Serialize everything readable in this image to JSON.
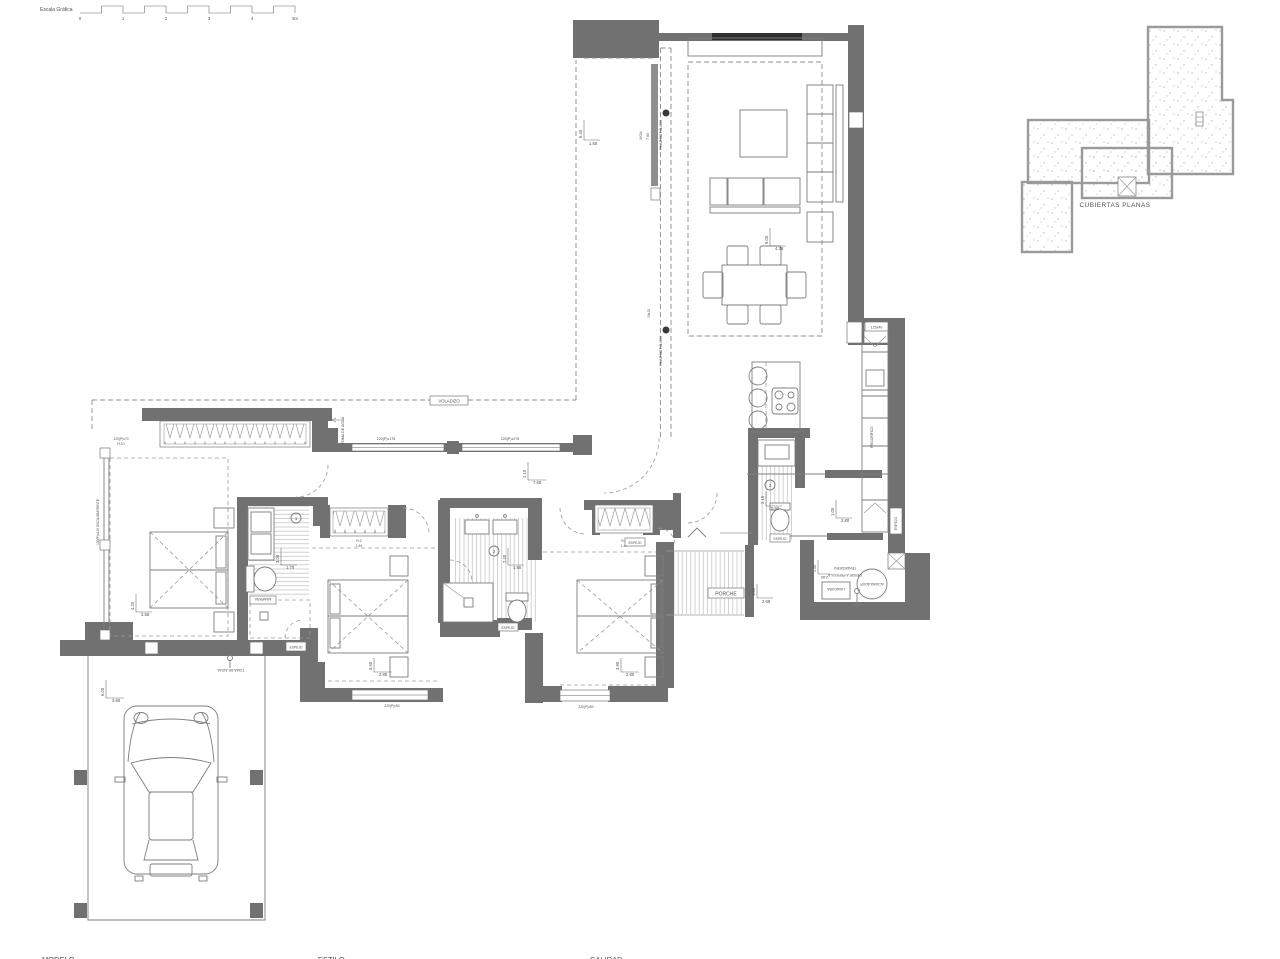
{
  "colors": {
    "wall": "#717171",
    "lintel": "#2f2f2f",
    "line": "#7d7d7d",
    "dash": "#8c8c8c",
    "text": "#4f4f4f"
  },
  "scalebar": {
    "title": "Escala Gráfica",
    "ticks": [
      "0",
      "1",
      "2",
      "3",
      "4",
      "5m"
    ]
  },
  "roof": {
    "label": "CUBIERTAS PLANAS"
  },
  "living": {
    "beam": "VIGA",
    "beam_len": "7.00",
    "pillar1": "PILAR METÁLICO",
    "pillar2": "PILAR METÁLICO",
    "pillar_size": "15x15",
    "dim1_v": "6.40",
    "dim1_h": "1.65",
    "dim2_v": "9.05",
    "dim2_h": "4.38"
  },
  "kitchen": {
    "tag": "125x40",
    "dim_v": "1.05",
    "dim_h": "2.80",
    "fridge": "FRIGORÍFICO"
  },
  "corridor": {
    "overhang": "VOLADIZO",
    "win1": "220(P)x175",
    "win2": "220(P)x275",
    "dim_v": "1.10",
    "dim_h": "7.60",
    "water": "TOMA DE AGUA"
  },
  "bed1": {
    "win_top_l1": "120(P)x70",
    "win_top_l2": "FIJO",
    "win_left": "100(P)x115 OSCILOBATIENTE",
    "dim_v": "4.20",
    "dim_h": "2.58",
    "num": "1",
    "bath_v": "3.05",
    "bath_h": "1.70",
    "tag": "MAMPARA"
  },
  "bed2": {
    "num": "2",
    "win_l1": "R:2",
    "win_l2": "1.40",
    "dim_v": "3.50",
    "dim_h": "2.88",
    "bath_v": "2.40",
    "bath_h": "1.90",
    "win_b": "220(P)x50"
  },
  "bed3": {
    "num": "3",
    "win_l1": "R:2",
    "win_l2": "1.40",
    "dim_v": "3.90",
    "dim_h": "2.80",
    "bath_v": "2.15",
    "bath_h": "0.90",
    "win_b": "220(P)x50"
  },
  "porch": {
    "label": "PORCHE",
    "dim_v": "1.50",
    "dim_h": "2.68"
  },
  "laundry": {
    "l1": "TENDEDERO",
    "l2": "DESDE A PERGOLA",
    "dim": "2.80",
    "dim_v": "1.50",
    "heater": "ACUMULADOR",
    "washer": "LAVADORA"
  },
  "garage": {
    "water": "TOMA DE AGUA",
    "dim_v": "6.00",
    "dim_h": "3.80"
  },
  "tags": {
    "t": "ESPEJO"
  },
  "titleblock": [
    "MODELO",
    "ESTILO",
    "CALIDAD"
  ]
}
